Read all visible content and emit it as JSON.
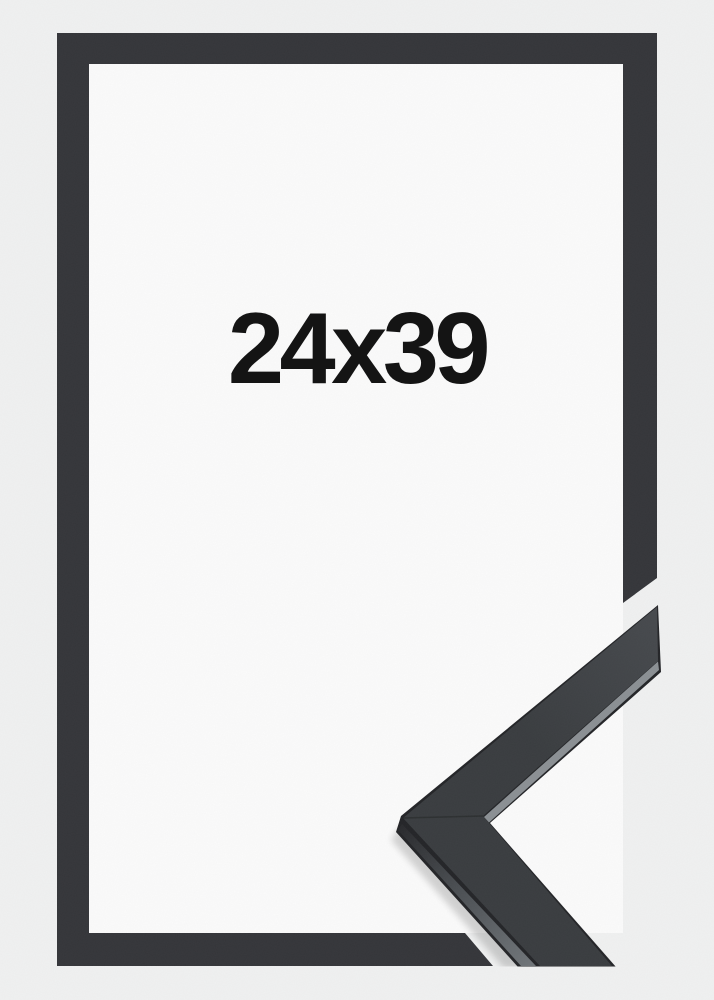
{
  "product": {
    "size_label": "24x39"
  },
  "colors": {
    "background": "#f0f1f1",
    "inner_background": "#fbfbfb",
    "frame_graphic": "#343539",
    "sample_face_dark": "#393c3f",
    "sample_face_light": "#474a4e",
    "sample_side_dark": "#28292c",
    "sample_side_light": "#6f7478",
    "sample_edge_highlight": "#8b9094",
    "sample_silhouette": "#232427",
    "label_text": "#141414"
  }
}
